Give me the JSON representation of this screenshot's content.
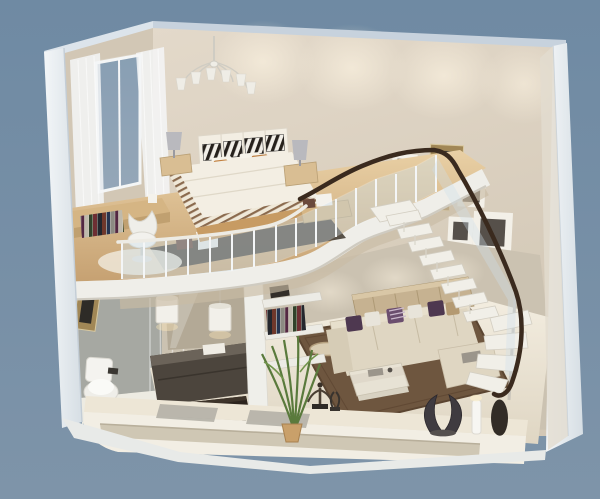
{
  "image": {
    "title": "3D cutaway loft apartment floor plan render",
    "description": "Isometric 3D cutaway rendering of a two-storey loft apartment: mezzanine bedroom with desk and curved glass balustrade above; living room, kitchenette and bathroom below; floating staircase along the right wall decorated with picture frames.",
    "width_px": 600,
    "height_px": 499
  },
  "palette": {
    "bg_top": "#6F8AA3",
    "bg_bottom": "#7E94A9",
    "wall_beige": "#E3D9CA",
    "wall_beige_dark": "#D2C7B5",
    "wall_cap_blue": "#C7D2DD",
    "cut_white": "#EFF2F5",
    "glow_warm": "#FBF2E0",
    "loft_wood": "#DFC092",
    "loft_wood_dark": "#C6A172",
    "floor_tile": "#EFE8DA",
    "carpet_brown": "#6E563F",
    "slab_white": "#EFEEE9",
    "glass_blue": "#CDE0EB",
    "handrail_brown": "#3A2A1E",
    "stair_tread": "#F1EFE8",
    "sofa_cream": "#DFD6C2",
    "pillow_purple": "#4E3850",
    "pillow_tan": "#B49A72",
    "bed_white": "#F3EEE3",
    "bed_wood": "#C79B63",
    "rug_dark": "#4A4238",
    "counter_dark": "#4C453D",
    "bench_black": "#2C241D",
    "plant_green": "#5A7A3C",
    "frame_gold": "#A18756",
    "frame_white": "#F3F0E8",
    "art_dark": "#56504A",
    "lamp_gray": "#B9B9BE",
    "bathroom_gray": "#A6A8A2",
    "sculpture_dark": "#38332E"
  },
  "scene": {
    "upper_level": {
      "name": "mezzanine bedroom",
      "objects": [
        "chandelier",
        "window with sheer curtains",
        "double bed with zebra-stripe pillows",
        "striped duvet",
        "two nightstands",
        "two table lamps",
        "low bookshelf with books",
        "writing desk",
        "white swivel chair",
        "round cream rug",
        "dark bed rug",
        "white storage boxes",
        "curved glass balustrade",
        "dark wood handrail"
      ]
    },
    "lower_level": {
      "name": "living area, kitchenette and bathroom",
      "objects": [
        "L-shaped cream sofa",
        "purple and white cushions",
        "glass coffee table",
        "brown area rug",
        "woven sideboard",
        "open wall shelves with books",
        "two white pendant lamps",
        "dark kitchenette counter",
        "black bench",
        "toilet",
        "glass shower screen",
        "gold framed picture",
        "potted plant",
        "front console ledge",
        "bronze figurine",
        "dark wing sculpture",
        "white pillar candle",
        "black vase",
        "gray trays"
      ]
    },
    "staircase": {
      "name": "floating staircase",
      "objects": [
        "white floating treads",
        "stair glass balustrade",
        "dark curved handrail",
        "lower winder treads",
        "support pole"
      ]
    },
    "wall_decor": {
      "picture_frames_count": 7,
      "picture_frames": [
        {
          "style": "gold",
          "orientation": "landscape"
        },
        {
          "style": "white",
          "orientation": "portrait"
        },
        {
          "style": "gold",
          "orientation": "landscape"
        },
        {
          "style": "white",
          "orientation": "portrait"
        },
        {
          "style": "white",
          "orientation": "portrait"
        },
        {
          "style": "white",
          "orientation": "portrait-large"
        },
        {
          "style": "gold",
          "orientation": "landscape"
        }
      ]
    }
  }
}
